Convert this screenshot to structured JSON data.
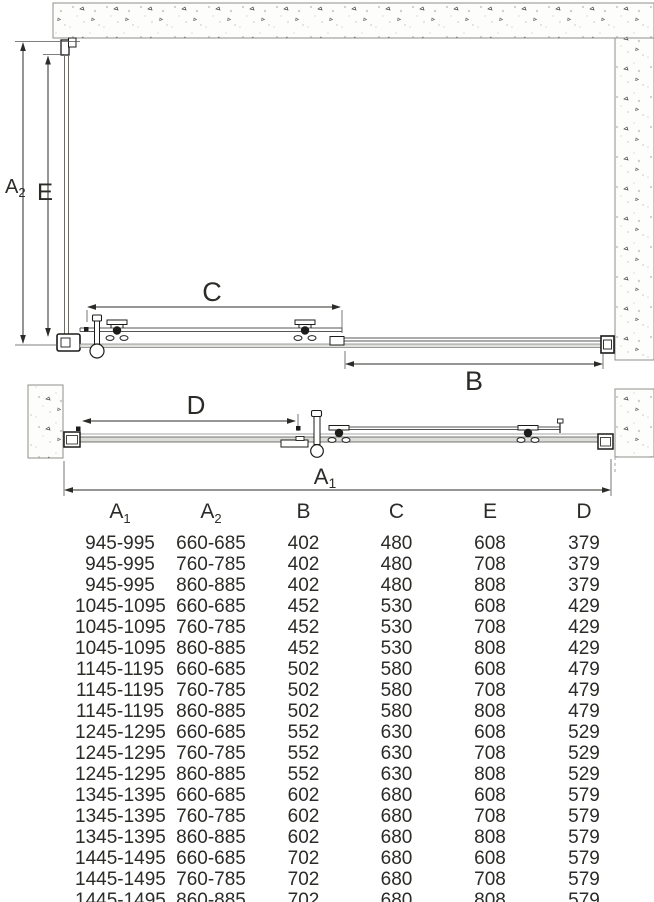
{
  "drawing": {
    "labels": {
      "a2": {
        "base": "A",
        "sub": "2"
      },
      "e": "E",
      "c": "C",
      "b": "B",
      "d": "D",
      "a1": {
        "base": "A",
        "sub": "1"
      }
    }
  },
  "table": {
    "headers": [
      {
        "base": "A",
        "sub": "1"
      },
      {
        "base": "A",
        "sub": "2"
      },
      {
        "base": "B",
        "sub": ""
      },
      {
        "base": "C",
        "sub": ""
      },
      {
        "base": "E",
        "sub": ""
      },
      {
        "base": "D",
        "sub": ""
      }
    ],
    "rows": [
      [
        "945-995",
        "660-685",
        "402",
        "480",
        "608",
        "379"
      ],
      [
        "945-995",
        "760-785",
        "402",
        "480",
        "708",
        "379"
      ],
      [
        "945-995",
        "860-885",
        "402",
        "480",
        "808",
        "379"
      ],
      [
        "1045-1095",
        "660-685",
        "452",
        "530",
        "608",
        "429"
      ],
      [
        "1045-1095",
        "760-785",
        "452",
        "530",
        "708",
        "429"
      ],
      [
        "1045-1095",
        "860-885",
        "452",
        "530",
        "808",
        "429"
      ],
      [
        "1145-1195",
        "660-685",
        "502",
        "580",
        "608",
        "479"
      ],
      [
        "1145-1195",
        "760-785",
        "502",
        "580",
        "708",
        "479"
      ],
      [
        "1145-1195",
        "860-885",
        "502",
        "580",
        "808",
        "479"
      ],
      [
        "1245-1295",
        "660-685",
        "552",
        "630",
        "608",
        "529"
      ],
      [
        "1245-1295",
        "760-785",
        "552",
        "630",
        "708",
        "529"
      ],
      [
        "1245-1295",
        "860-885",
        "552",
        "630",
        "808",
        "529"
      ],
      [
        "1345-1395",
        "660-685",
        "602",
        "680",
        "608",
        "579"
      ],
      [
        "1345-1395",
        "760-785",
        "602",
        "680",
        "708",
        "579"
      ],
      [
        "1345-1395",
        "860-885",
        "602",
        "680",
        "808",
        "579"
      ],
      [
        "1445-1495",
        "660-685",
        "702",
        "680",
        "608",
        "579"
      ],
      [
        "1445-1495",
        "760-785",
        "702",
        "680",
        "708",
        "579"
      ],
      [
        "1445-1495",
        "860-885",
        "702",
        "680",
        "808",
        "579"
      ]
    ]
  }
}
